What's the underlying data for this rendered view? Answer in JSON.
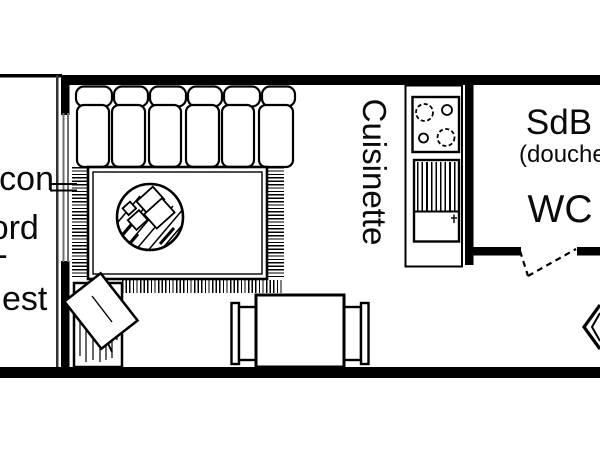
{
  "plan": {
    "type": "floor-plan",
    "labels": {
      "balcony": {
        "lines": [
          "Balcon",
          "Nord",
          "-",
          "Ouest"
        ]
      },
      "kitchenette": "Cuisinette",
      "bathroom": "SdB",
      "bathroom_detail": "(douche)",
      "toilet": "WC"
    },
    "furniture": [
      "sofa",
      "area-rug",
      "round-coffee-table",
      "armchair",
      "dining-table",
      "dining-chair-left",
      "dining-chair-right",
      "cooktop-4-burners",
      "kitchen-unit",
      "kitchen-counter",
      "window-wall",
      "bathroom-door-swing",
      "entry-arrow"
    ],
    "colors": {
      "ink": "#000000",
      "paper": "#ffffff",
      "glazing": "#6e6e6e"
    }
  }
}
